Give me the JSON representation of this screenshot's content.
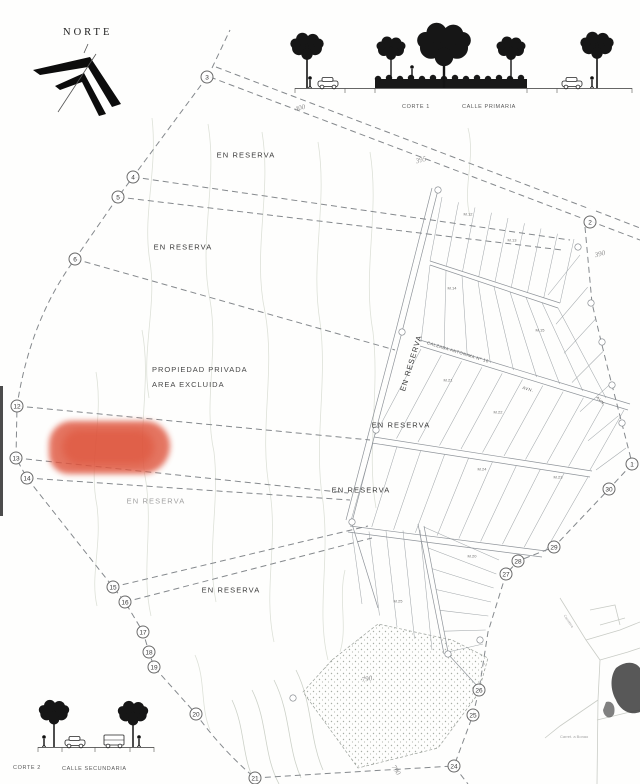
{
  "compass": {
    "label": "NORTE"
  },
  "sections": {
    "primary": {
      "corte": "CORTE 1",
      "calle": "CALLE PRIMARIA"
    },
    "secondary": {
      "corte": "CORTE 2",
      "calle": "CALLE SECUNDARIA"
    }
  },
  "plat": {
    "private_area_line1": "PROPIEDAD PRIVADA",
    "private_area_line2": "AREA EXCLUIDA",
    "reserve_labels": [
      {
        "text": "EN RESERVA",
        "x": 246,
        "y": 155,
        "rot": 0,
        "dim": false
      },
      {
        "text": "EN RESERVA",
        "x": 183,
        "y": 247,
        "rot": 0,
        "dim": false
      },
      {
        "text": "EN RESERVA",
        "x": 411,
        "y": 363,
        "rot": -73,
        "dim": false
      },
      {
        "text": "EN RESERVA",
        "x": 401,
        "y": 425,
        "rot": 0,
        "dim": false
      },
      {
        "text": "EN RESERVA",
        "x": 361,
        "y": 490,
        "rot": 0,
        "dim": false
      },
      {
        "text": "EN RESERVA",
        "x": 156,
        "y": 501,
        "rot": 0,
        "dim": true
      },
      {
        "text": "EN RESERVA",
        "x": 231,
        "y": 590,
        "rot": 0,
        "dim": false
      }
    ],
    "elevation_labels": [
      {
        "text": "400",
        "x": 300,
        "y": 108,
        "rot": -16
      },
      {
        "text": "395",
        "x": 421,
        "y": 160,
        "rot": -16
      },
      {
        "text": "390",
        "x": 600,
        "y": 254,
        "rot": -14
      },
      {
        "text": "790",
        "x": 367,
        "y": 679,
        "rot": -10
      },
      {
        "text": "790",
        "x": 396,
        "y": 770,
        "rot": 58
      }
    ],
    "markers": [
      {
        "label": "3",
        "x": 207,
        "y": 77
      },
      {
        "label": "4",
        "x": 133,
        "y": 177
      },
      {
        "label": "5",
        "x": 118,
        "y": 197
      },
      {
        "label": "6",
        "x": 75,
        "y": 259
      },
      {
        "label": "12",
        "x": 17,
        "y": 406
      },
      {
        "label": "13",
        "x": 16,
        "y": 458
      },
      {
        "label": "14",
        "x": 27,
        "y": 478
      },
      {
        "label": "15",
        "x": 113,
        "y": 587
      },
      {
        "label": "16",
        "x": 125,
        "y": 602
      },
      {
        "label": "17",
        "x": 143,
        "y": 632
      },
      {
        "label": "18",
        "x": 149,
        "y": 652
      },
      {
        "label": "19",
        "x": 154,
        "y": 667
      },
      {
        "label": "20",
        "x": 196,
        "y": 714
      },
      {
        "label": "21",
        "x": 255,
        "y": 778
      },
      {
        "label": "2",
        "x": 590,
        "y": 222
      },
      {
        "label": "1",
        "x": 632,
        "y": 464
      },
      {
        "label": "30",
        "x": 609,
        "y": 489
      },
      {
        "label": "29",
        "x": 554,
        "y": 547
      },
      {
        "label": "28",
        "x": 518,
        "y": 561
      },
      {
        "label": "27",
        "x": 506,
        "y": 574
      },
      {
        "label": "26",
        "x": 479,
        "y": 690
      },
      {
        "label": "25",
        "x": 473,
        "y": 715
      },
      {
        "label": "24",
        "x": 454,
        "y": 766
      }
    ],
    "parcel_labels": [
      {
        "text": "M.12",
        "x": 468,
        "y": 214
      },
      {
        "text": "M.13",
        "x": 512,
        "y": 240
      },
      {
        "text": "M.14",
        "x": 452,
        "y": 288
      },
      {
        "text": "M.15",
        "x": 540,
        "y": 330
      },
      {
        "text": "M.21",
        "x": 448,
        "y": 380
      },
      {
        "text": "M.22",
        "x": 498,
        "y": 412
      },
      {
        "text": "M.24",
        "x": 482,
        "y": 469
      },
      {
        "text": "M.23",
        "x": 558,
        "y": 477
      },
      {
        "text": "M.20",
        "x": 472,
        "y": 556
      },
      {
        "text": "M.25",
        "x": 398,
        "y": 601
      }
    ],
    "street_labels": [
      {
        "text": "CALZADA ANTONIMA Nº 10",
        "x": 458,
        "y": 352,
        "rot": 17
      },
      {
        "text": "AVN.",
        "x": 528,
        "y": 389,
        "rot": 17
      },
      {
        "text": "AVN.",
        "x": 601,
        "y": 401,
        "rot": 48
      }
    ],
    "inset": {
      "caption": "Carret. a Bonao",
      "road_label": "Carretera"
    }
  }
}
